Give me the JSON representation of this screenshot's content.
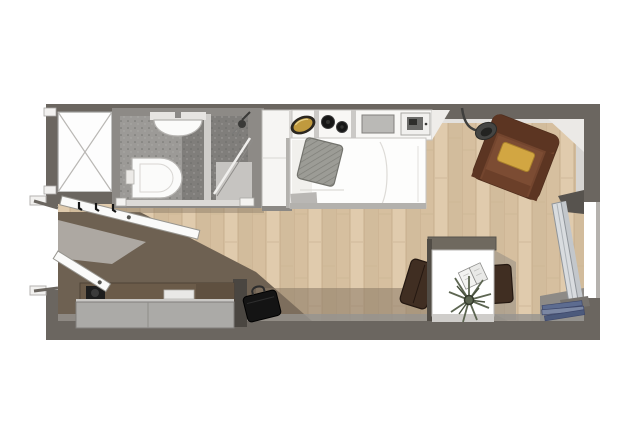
{
  "palette": {
    "bg": "#ffffff",
    "wall": "#6b6660",
    "wall_inner": "#d7d5d2",
    "wall_light": "#ebe9e6",
    "wood_base": "#dbc6a8",
    "wood_line": "#c2aa88",
    "mat": "#6e6152",
    "shadow_wood": "#8a7a66",
    "bath_wall": "#8d8a86",
    "bath_floor": "#9c9a97",
    "bath_floor_dark": "#807e7b",
    "fixture_white": "#fbfbfa",
    "glass": "#d9dcdf",
    "cabinet_white": "#f6f5f3",
    "counter": "#f8f7f5",
    "sink_gold": "#c09a3e",
    "sink_rim": "#2b2720",
    "burner_black": "#161616",
    "tray_gray": "#bab9b6",
    "bed_white": "#fdfdfc",
    "bed_frame": "#b3b1ad",
    "pillow_gray": "#9c9c96",
    "armchair_brown": "#73452e",
    "armchair_dark": "#5c3522",
    "cushion_yellow": "#d2a642",
    "lamp_gray": "#454543",
    "magazine_blue": "#5d6c90",
    "desk_band": "#6f695f",
    "desk_white": "#ffffff",
    "chair_office": "#402e22",
    "plant_green": "#5d6652",
    "sideboard_top": "#6b5b49",
    "sideboard_front": "#abaaa7",
    "black_item": "#141414",
    "door_white": "#fafaf9"
  },
  "labels": {
    "scene": "Studio apartment floor plan",
    "wood_floor": "wood floor",
    "entry_mat": "entry floor",
    "shaft": "shaft",
    "bathroom": "bathroom",
    "washbasin": "washbasin",
    "toilet": "toilet",
    "shower": "shower",
    "shower_head": "shower head",
    "shower_door": "shower glass door",
    "bathroom_door": "bathroom door",
    "wardrobe": "wardrobe",
    "kitchenette": "kitchenette",
    "kitchen_sink": "kitchen sink",
    "cooktop": "cooktop burners",
    "cutting_board": "cutting board",
    "microwave": "microwave",
    "bed": "bed",
    "pillow": "pillow",
    "armchair": "armchair",
    "seat_cushion": "seat cushion",
    "floor_lamp": "floor lamp",
    "balcony_door": "open balcony door",
    "magazines": "magazines",
    "desk": "desk",
    "desk_chair": "desk chair",
    "side_chair": "side chair",
    "book": "open book",
    "plant": "plant",
    "sideboard": "sideboard",
    "speaker": "speaker",
    "tray": "tray",
    "briefcase": "briefcase",
    "entrance_door": "entrance door",
    "closet_door": "closet door",
    "coat_hooks": "coat hooks"
  }
}
